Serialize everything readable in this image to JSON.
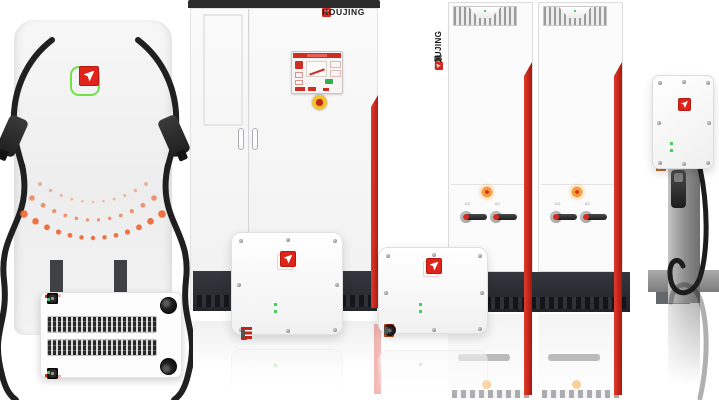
{
  "brand": {
    "name": "HOUJING",
    "cn": "厚景"
  },
  "cabinet": {
    "logo_text": "HOUJING"
  },
  "rack": {
    "vertical_cn": "厚景",
    "vertical_en": "HOUJING",
    "towers": 2,
    "modules_per_tower": 8,
    "switch_labels": [
      "DC",
      "AC"
    ]
  },
  "units": {
    "mini_logo": "HOUJING"
  },
  "colors": {
    "logo_red": "#d7261d",
    "stripe_red": "#c9241a",
    "led_green": "#3ecf53",
    "connector_orange": "#e8571f",
    "dot_orange": "#ee6a38",
    "base_dark": "#2b2e33",
    "frame_green": "#6fe24a",
    "background": "#ffffff"
  }
}
